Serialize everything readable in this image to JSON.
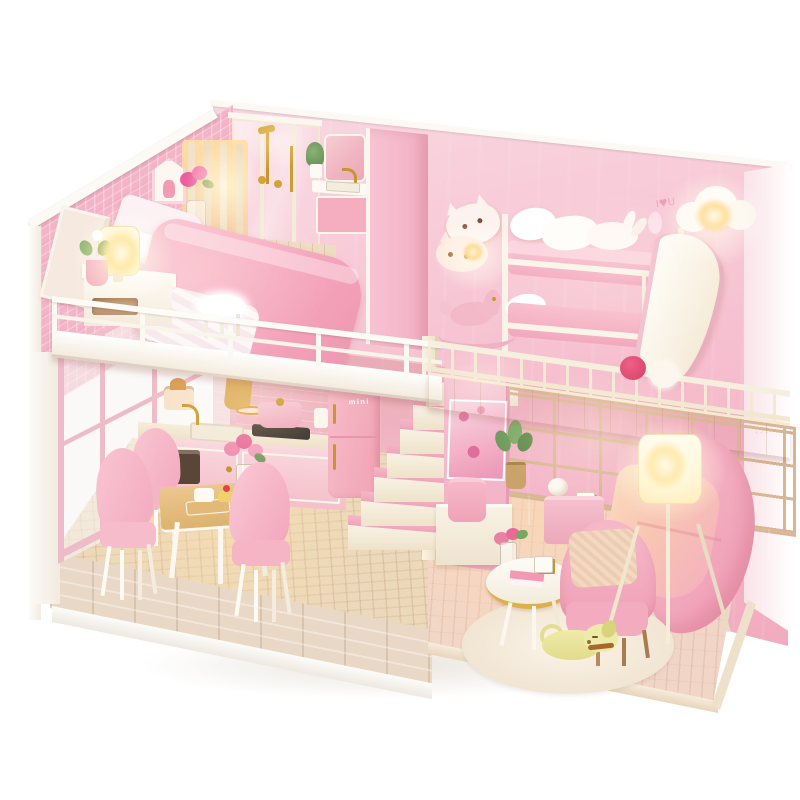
{
  "meta": {
    "type": "product-photo",
    "subject": "DIY miniature dollhouse kit — pink two-story loft apartment with LED lighting, photographed on a white background",
    "background_color": "#ffffff"
  },
  "labels": {
    "fridge": "mini",
    "wall_art": "I♥U"
  },
  "palette": {
    "wall_pink": "#f5bfd0",
    "gingham_pink": "#f3b2c7",
    "partition_pink": "#f4b6c8",
    "right_wall": "#fbecf0",
    "wood_light": "#ecd8ba",
    "floor_right": "#f1d6c8",
    "brick_edge": "#e9d8c5",
    "white_trim": "#faf5ec",
    "railing_cream": "#f4ebd6",
    "gold": "#c8962e",
    "sofa_pink": "#f4afc0",
    "chair_pink": "#f5b5c5",
    "duvet_pink": "#f4a9bf",
    "fridge_pink": "#f3aebc",
    "lamp_glow": "#ffd98f",
    "rug_cream": "#f7eee3",
    "dog_yellow": "#e9e59c",
    "plant_green": "#6f9d5f"
  },
  "rooms": {
    "bedroom_loft": {
      "title": "bedroom loft",
      "objects": [
        "double-bed",
        "pink-duvet",
        "white-pillows",
        "tilted-headboard",
        "nightstand",
        "glowing-table-lamp",
        "pink-potted-plant",
        "leaning-picture-frame",
        "house-shaped-wall-decor",
        "magenta-flower-vase",
        "slatted-screen-with-light",
        "fur-stool",
        "white-loft-railing"
      ]
    },
    "bathroom": {
      "title": "bathroom",
      "objects": [
        "glass-shower-stall",
        "gold-shower-fixture",
        "vanity-with-sink",
        "gold-faucet",
        "mirror",
        "green-plant",
        "pink-partition-wall"
      ]
    },
    "kids_room": {
      "title": "bunk room",
      "objects": [
        "bunk-bed",
        "pink-bedding",
        "white-pillows",
        "bunny-pillow",
        "ladder",
        "white-slide",
        "cat-wall-lights",
        "cloud-wall-light",
        "rocking-horse",
        "red-pompom",
        "white-pompom",
        "balcony-railing"
      ]
    },
    "kitchen": {
      "title": "kitchen",
      "objects": [
        "counter-with-sink",
        "gold-faucet",
        "cooktop",
        "pink-pot",
        "toaster",
        "cutting-board",
        "pink-retro-fridge"
      ]
    },
    "dining": {
      "title": "dining nook",
      "objects": [
        "wood-dining-table",
        "pink-chair-left",
        "pink-chair-back",
        "pink-chair-right",
        "rose-vase",
        "cream-cake",
        "cupcake",
        "canister"
      ]
    },
    "living_room": {
      "title": "living room",
      "objects": [
        "shoji-window-wall",
        "tv-art-panel",
        "media-console",
        "pink-speaker",
        "potted-plant",
        "pink-side-table",
        "pink-sofa",
        "tripod-floor-lamp",
        "pink-armchair",
        "round-coffee-table",
        "stacked-books",
        "mug",
        "rose-posy",
        "round-cream-rug",
        "sleeping-yellow-dog"
      ]
    },
    "structure": {
      "title": "structure",
      "objects": [
        "gingham-left-wall",
        "glass-door-wall",
        "pink-back-wall",
        "staircase-with-pink-treads",
        "corner-post",
        "wood-platform-base",
        "brick-front-edge"
      ]
    }
  }
}
